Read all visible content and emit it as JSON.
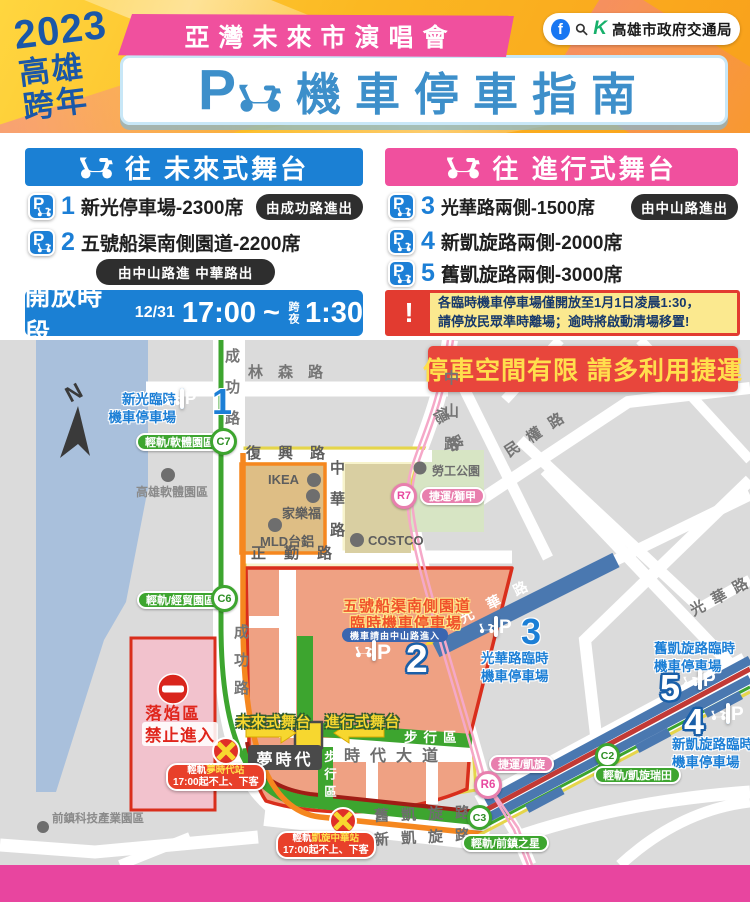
{
  "colors": {
    "accent_blue": "#1C7FD6",
    "accent_pink": "#F0509E",
    "warn_red": "#E23B30",
    "warn_yellow": "#FBE98F",
    "route_green": "#3DA52F",
    "route_orange": "#F5871F",
    "notice_red": "#E8463C",
    "notice_text": "#FFDF4D",
    "footer_pink": "#E8459F"
  },
  "header": {
    "year": "2023",
    "city_top": "高雄",
    "city_bottom": "跨年",
    "ribbon": "亞灣未來市演唱會",
    "parking_letter": "P",
    "title": "機車停車指南",
    "fb": "f",
    "k": "K",
    "agency": "高雄市政府交通局"
  },
  "columns": {
    "left": {
      "title": "往 未來式舞台",
      "items": [
        {
          "num": "1",
          "name": "新光停車場-2300席",
          "note": "由成功路進出"
        },
        {
          "num": "2",
          "name": "五號船渠南側園道-2200席",
          "note": "由中山路進  中華路出"
        }
      ]
    },
    "right": {
      "title": "往 進行式舞台",
      "items": [
        {
          "num": "3",
          "name": "光華路兩側-1500席",
          "note": "由中山路進出"
        },
        {
          "num": "4",
          "name": "新凱旋路兩側-2000席"
        },
        {
          "num": "5",
          "name": "舊凱旋路兩側-3000席"
        }
      ]
    }
  },
  "hours": {
    "label": "開放時段",
    "date": "12/31",
    "start": "17:00",
    "tilde": "~",
    "overnight": "跨夜",
    "end": "1:30"
  },
  "warning": {
    "mark": "!",
    "line1": "各臨時機車停車場僅開放至1月1日凌晨1:30，",
    "line2": "請停放民眾準時離場；逾時將啟動清場移置!"
  },
  "map": {
    "notice": "停車空間有限  請多利用捷運",
    "compass": "N",
    "roads": {
      "chenggong_top": "成功路",
      "chenggong_bottom": "成功路",
      "linsen": "林森路",
      "fuxing": "復興路",
      "zhengqin": "正勤路",
      "zhonghua": "中華路",
      "zhongshan": "中山路",
      "de": "德路",
      "minquan": "民權路",
      "guanghua_gray": "光華路",
      "guanghua_band": "光華路",
      "shidai": "時代大道",
      "jiukaixuan": "舊凱旋路",
      "xinkaixuan": "新凱旋路"
    },
    "places": {
      "software_park": "高雄軟體園區",
      "labor_park": "勞工公園",
      "qianzhen": "前鎮科技產業園區",
      "ikea": "IKEA",
      "carrefour": "家樂福",
      "mld": "MLD台鋁",
      "costco": "COSTCO",
      "dream_mall": "夢時代"
    },
    "zones": {
      "firework_line1": "落焰區",
      "firework_line2": "禁止進入",
      "walk_h": "步行區",
      "walk_v": "步行區",
      "stage_future": "未來式舞台",
      "stage_progress": "進行式舞台"
    },
    "parking": {
      "p1": {
        "num": "1",
        "line1": "新光臨時",
        "line2": "機車停車場"
      },
      "p2": {
        "num": "2",
        "line1": "五號船渠南側園道",
        "line2": "臨時機車停車場",
        "pill": "機車請由中山路進入"
      },
      "p3": {
        "num": "3",
        "line1": "光華路臨時",
        "line2": "機車停車場"
      },
      "p4": {
        "num": "4",
        "line1": "新凱旋路臨時",
        "line2": "機車停車場"
      },
      "p5": {
        "num": "5",
        "line1": "舊凱旋路臨時",
        "line2": "機車停車場"
      }
    },
    "transit": {
      "c7": {
        "code": "C7",
        "label": "輕軌/軟體園區"
      },
      "c6": {
        "code": "C6",
        "label": "輕軌/經貿園區"
      },
      "r7": {
        "code": "R7",
        "label": "捷運/獅甲"
      },
      "r6": {
        "code": "R6",
        "label": "捷運/凱旋"
      },
      "c2": {
        "code": "C2",
        "label": "輕軌/凱旋瑞田"
      },
      "c3": {
        "code": "C3",
        "label": "輕軌/前鎮之星"
      }
    },
    "closures": {
      "dream": {
        "prefix": "輕軌",
        "station": "夢時代站",
        "line2": "17:00起不上、下客"
      },
      "kaixuan": {
        "prefix": "輕軌",
        "station": "凱旋中華站",
        "line2": "17:00起不上、下客"
      }
    }
  }
}
